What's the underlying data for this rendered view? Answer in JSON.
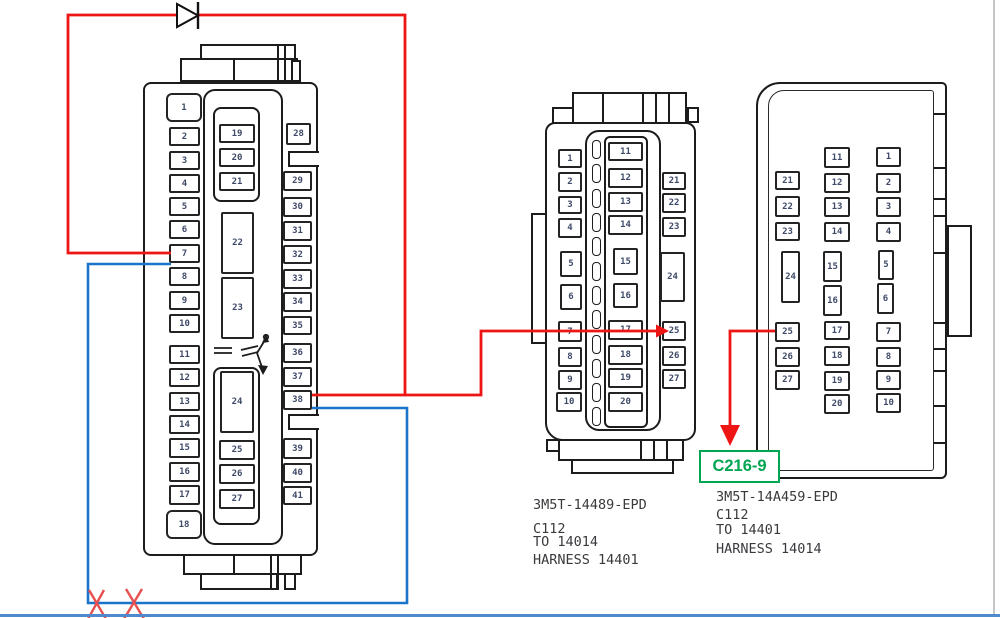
{
  "canvas": {
    "width": 1000,
    "height": 618,
    "background": "#ffffff"
  },
  "colors": {
    "outline": "#1c1c1c",
    "pin_text": "#3f4a68",
    "label_text": "#3a3a3e",
    "wire_red": "#ee1515",
    "wire_blue": "#1a74ca",
    "x_mark_red": "#e85050",
    "callout_green": "#00a651",
    "window_bottom_line": "#5089cc",
    "window_right_line": "#c6c6c6"
  },
  "left_connector": {
    "pins": [
      {
        "n": "1",
        "x": 166,
        "y": 93,
        "w": 36,
        "h": 29,
        "r": 6
      },
      {
        "n": "2",
        "x": 169,
        "y": 127,
        "w": 31,
        "h": 19
      },
      {
        "n": "3",
        "x": 169,
        "y": 151,
        "w": 31,
        "h": 19
      },
      {
        "n": "4",
        "x": 169,
        "y": 174,
        "w": 31,
        "h": 19
      },
      {
        "n": "5",
        "x": 169,
        "y": 197,
        "w": 31,
        "h": 19
      },
      {
        "n": "6",
        "x": 169,
        "y": 220,
        "w": 31,
        "h": 19
      },
      {
        "n": "7",
        "x": 169,
        "y": 244,
        "w": 31,
        "h": 19
      },
      {
        "n": "8",
        "x": 169,
        "y": 267,
        "w": 31,
        "h": 19
      },
      {
        "n": "9",
        "x": 169,
        "y": 291,
        "w": 31,
        "h": 19
      },
      {
        "n": "10",
        "x": 169,
        "y": 314,
        "w": 31,
        "h": 19
      },
      {
        "n": "11",
        "x": 169,
        "y": 345,
        "w": 31,
        "h": 19
      },
      {
        "n": "12",
        "x": 169,
        "y": 368,
        "w": 31,
        "h": 19
      },
      {
        "n": "13",
        "x": 169,
        "y": 392,
        "w": 31,
        "h": 19
      },
      {
        "n": "14",
        "x": 169,
        "y": 415,
        "w": 31,
        "h": 19
      },
      {
        "n": "15",
        "x": 169,
        "y": 438,
        "w": 31,
        "h": 20
      },
      {
        "n": "16",
        "x": 169,
        "y": 462,
        "w": 31,
        "h": 20
      },
      {
        "n": "17",
        "x": 169,
        "y": 485,
        "w": 31,
        "h": 20
      },
      {
        "n": "18",
        "x": 166,
        "y": 510,
        "w": 36,
        "h": 29,
        "r": 6
      },
      {
        "n": "19",
        "x": 219,
        "y": 124,
        "w": 36,
        "h": 19
      },
      {
        "n": "20",
        "x": 219,
        "y": 148,
        "w": 36,
        "h": 19
      },
      {
        "n": "21",
        "x": 219,
        "y": 172,
        "w": 36,
        "h": 19
      },
      {
        "n": "22",
        "x": 221,
        "y": 212,
        "w": 33,
        "h": 62
      },
      {
        "n": "23",
        "x": 221,
        "y": 277,
        "w": 33,
        "h": 62
      },
      {
        "n": "24",
        "x": 220,
        "y": 371,
        "w": 34,
        "h": 62
      },
      {
        "n": "25",
        "x": 219,
        "y": 440,
        "w": 36,
        "h": 20
      },
      {
        "n": "26",
        "x": 219,
        "y": 464,
        "w": 36,
        "h": 20
      },
      {
        "n": "27",
        "x": 219,
        "y": 489,
        "w": 36,
        "h": 20
      },
      {
        "n": "28",
        "x": 286,
        "y": 123,
        "w": 25,
        "h": 22
      },
      {
        "n": "29",
        "x": 283,
        "y": 171,
        "w": 29,
        "h": 20
      },
      {
        "n": "30",
        "x": 283,
        "y": 197,
        "w": 29,
        "h": 20
      },
      {
        "n": "31",
        "x": 283,
        "y": 221,
        "w": 29,
        "h": 20
      },
      {
        "n": "32",
        "x": 283,
        "y": 245,
        "w": 29,
        "h": 19
      },
      {
        "n": "33",
        "x": 283,
        "y": 269,
        "w": 29,
        "h": 20
      },
      {
        "n": "34",
        "x": 283,
        "y": 292,
        "w": 29,
        "h": 20
      },
      {
        "n": "35",
        "x": 283,
        "y": 316,
        "w": 29,
        "h": 19
      },
      {
        "n": "36",
        "x": 283,
        "y": 343,
        "w": 29,
        "h": 20
      },
      {
        "n": "37",
        "x": 283,
        "y": 367,
        "w": 29,
        "h": 20
      },
      {
        "n": "38",
        "x": 283,
        "y": 390,
        "w": 29,
        "h": 20
      },
      {
        "n": "39",
        "x": 283,
        "y": 438,
        "w": 29,
        "h": 21
      },
      {
        "n": "40",
        "x": 283,
        "y": 463,
        "w": 29,
        "h": 20
      },
      {
        "n": "41",
        "x": 283,
        "y": 486,
        "w": 29,
        "h": 19
      }
    ]
  },
  "middle_connector": {
    "label_lines": [
      "3M5T-14489-EPD",
      "C112",
      "TO 14014",
      "HARNESS 14401"
    ],
    "slots": {
      "x": 592,
      "w": 9,
      "h": 19,
      "ys": [
        140,
        164,
        189,
        213,
        237,
        262,
        286,
        310,
        335,
        359,
        383,
        407
      ]
    },
    "pins": [
      {
        "n": "1",
        "x": 558,
        "y": 149,
        "w": 24,
        "h": 19
      },
      {
        "n": "2",
        "x": 558,
        "y": 172,
        "w": 24,
        "h": 20
      },
      {
        "n": "3",
        "x": 558,
        "y": 196,
        "w": 24,
        "h": 18
      },
      {
        "n": "4",
        "x": 558,
        "y": 218,
        "w": 24,
        "h": 20
      },
      {
        "n": "5",
        "x": 560,
        "y": 251,
        "w": 22,
        "h": 26
      },
      {
        "n": "6",
        "x": 560,
        "y": 284,
        "w": 22,
        "h": 26
      },
      {
        "n": "7",
        "x": 558,
        "y": 321,
        "w": 24,
        "h": 21
      },
      {
        "n": "8",
        "x": 558,
        "y": 347,
        "w": 24,
        "h": 20
      },
      {
        "n": "9",
        "x": 558,
        "y": 370,
        "w": 24,
        "h": 20
      },
      {
        "n": "10",
        "x": 556,
        "y": 392,
        "w": 26,
        "h": 20
      },
      {
        "n": "11",
        "x": 608,
        "y": 142,
        "w": 35,
        "h": 19
      },
      {
        "n": "12",
        "x": 608,
        "y": 168,
        "w": 35,
        "h": 20
      },
      {
        "n": "13",
        "x": 608,
        "y": 192,
        "w": 35,
        "h": 20
      },
      {
        "n": "14",
        "x": 608,
        "y": 215,
        "w": 35,
        "h": 20
      },
      {
        "n": "15",
        "x": 613,
        "y": 248,
        "w": 25,
        "h": 27
      },
      {
        "n": "16",
        "x": 613,
        "y": 283,
        "w": 25,
        "h": 25
      },
      {
        "n": "17",
        "x": 608,
        "y": 320,
        "w": 35,
        "h": 20
      },
      {
        "n": "18",
        "x": 608,
        "y": 345,
        "w": 35,
        "h": 20
      },
      {
        "n": "19",
        "x": 608,
        "y": 368,
        "w": 35,
        "h": 20
      },
      {
        "n": "20",
        "x": 608,
        "y": 392,
        "w": 35,
        "h": 20
      },
      {
        "n": "21",
        "x": 662,
        "y": 172,
        "w": 24,
        "h": 18
      },
      {
        "n": "22",
        "x": 662,
        "y": 193,
        "w": 24,
        "h": 20
      },
      {
        "n": "23",
        "x": 662,
        "y": 217,
        "w": 24,
        "h": 20
      },
      {
        "n": "24",
        "x": 660,
        "y": 252,
        "w": 25,
        "h": 50
      },
      {
        "n": "25",
        "x": 662,
        "y": 321,
        "w": 24,
        "h": 20
      },
      {
        "n": "26",
        "x": 662,
        "y": 346,
        "w": 24,
        "h": 20
      },
      {
        "n": "27",
        "x": 662,
        "y": 369,
        "w": 24,
        "h": 20
      }
    ]
  },
  "right_connector": {
    "label_lines": [
      "3M5T-14A459-EPD",
      "C112",
      "TO 14401",
      "HARNESS 14014"
    ],
    "ticks": [
      113,
      167,
      198,
      215,
      252,
      322,
      348,
      370,
      405,
      442
    ],
    "pins": [
      {
        "n": "21",
        "x": 775,
        "y": 171,
        "w": 25,
        "h": 19
      },
      {
        "n": "22",
        "x": 775,
        "y": 196,
        "w": 25,
        "h": 21
      },
      {
        "n": "23",
        "x": 775,
        "y": 222,
        "w": 25,
        "h": 19
      },
      {
        "n": "24",
        "x": 781,
        "y": 251,
        "w": 19,
        "h": 52
      },
      {
        "n": "25",
        "x": 775,
        "y": 322,
        "w": 25,
        "h": 20
      },
      {
        "n": "26",
        "x": 775,
        "y": 347,
        "w": 25,
        "h": 20
      },
      {
        "n": "27",
        "x": 775,
        "y": 370,
        "w": 25,
        "h": 20
      },
      {
        "n": "11",
        "x": 824,
        "y": 147,
        "w": 26,
        "h": 21
      },
      {
        "n": "12",
        "x": 824,
        "y": 173,
        "w": 26,
        "h": 20
      },
      {
        "n": "13",
        "x": 824,
        "y": 197,
        "w": 26,
        "h": 20
      },
      {
        "n": "14",
        "x": 824,
        "y": 222,
        "w": 26,
        "h": 20
      },
      {
        "n": "15",
        "x": 823,
        "y": 251,
        "w": 19,
        "h": 31
      },
      {
        "n": "16",
        "x": 823,
        "y": 285,
        "w": 19,
        "h": 31
      },
      {
        "n": "17",
        "x": 824,
        "y": 321,
        "w": 26,
        "h": 19
      },
      {
        "n": "18",
        "x": 824,
        "y": 346,
        "w": 26,
        "h": 20
      },
      {
        "n": "19",
        "x": 824,
        "y": 371,
        "w": 26,
        "h": 20
      },
      {
        "n": "20",
        "x": 824,
        "y": 394,
        "w": 26,
        "h": 20
      },
      {
        "n": "1",
        "x": 876,
        "y": 147,
        "w": 25,
        "h": 20
      },
      {
        "n": "2",
        "x": 876,
        "y": 173,
        "w": 25,
        "h": 20
      },
      {
        "n": "3",
        "x": 876,
        "y": 197,
        "w": 25,
        "h": 20
      },
      {
        "n": "4",
        "x": 876,
        "y": 222,
        "w": 25,
        "h": 20
      },
      {
        "n": "5",
        "x": 878,
        "y": 250,
        "w": 16,
        "h": 30
      },
      {
        "n": "6",
        "x": 877,
        "y": 283,
        "w": 17,
        "h": 31
      },
      {
        "n": "7",
        "x": 876,
        "y": 322,
        "w": 25,
        "h": 20
      },
      {
        "n": "8",
        "x": 876,
        "y": 347,
        "w": 25,
        "h": 20
      },
      {
        "n": "9",
        "x": 876,
        "y": 370,
        "w": 25,
        "h": 20
      },
      {
        "n": "10",
        "x": 876,
        "y": 393,
        "w": 25,
        "h": 20
      }
    ]
  },
  "callout": {
    "text": "C216-9"
  },
  "wires": {
    "red": [
      {
        "points": [
          [
            171,
            253
          ],
          [
            68,
            253
          ],
          [
            68,
            15
          ],
          [
            405,
            15
          ],
          [
            405,
            395
          ],
          [
            312,
            395
          ]
        ]
      },
      {
        "points": [
          [
            405,
            395
          ],
          [
            481,
            395
          ],
          [
            481,
            331
          ],
          [
            657,
            331
          ]
        ],
        "arrow": {
          "tip": [
            669,
            331
          ],
          "dir": "right"
        }
      },
      {
        "points": [
          [
            775,
            331
          ],
          [
            730,
            331
          ],
          [
            730,
            427
          ]
        ],
        "arrow": {
          "tip": [
            730,
            446
          ],
          "dir": "down"
        }
      }
    ],
    "blue": [
      {
        "points": [
          [
            171,
            264
          ],
          [
            88,
            264
          ],
          [
            88,
            603
          ],
          [
            407,
            603
          ],
          [
            407,
            408
          ],
          [
            312,
            408
          ]
        ]
      }
    ],
    "diode": {
      "x": 177,
      "y": 4,
      "w": 21,
      "h": 23
    },
    "x_marks": [
      {
        "lines": [
          [
            [
              89,
              590
            ],
            [
              106,
              619
            ]
          ],
          [
            [
              104,
              590
            ],
            [
              88,
              619
            ]
          ]
        ]
      },
      {
        "lines": [
          [
            [
              126,
              589
            ],
            [
              144,
              619
            ]
          ],
          [
            [
              142,
              589
            ],
            [
              124,
              619
            ]
          ]
        ]
      }
    ]
  }
}
